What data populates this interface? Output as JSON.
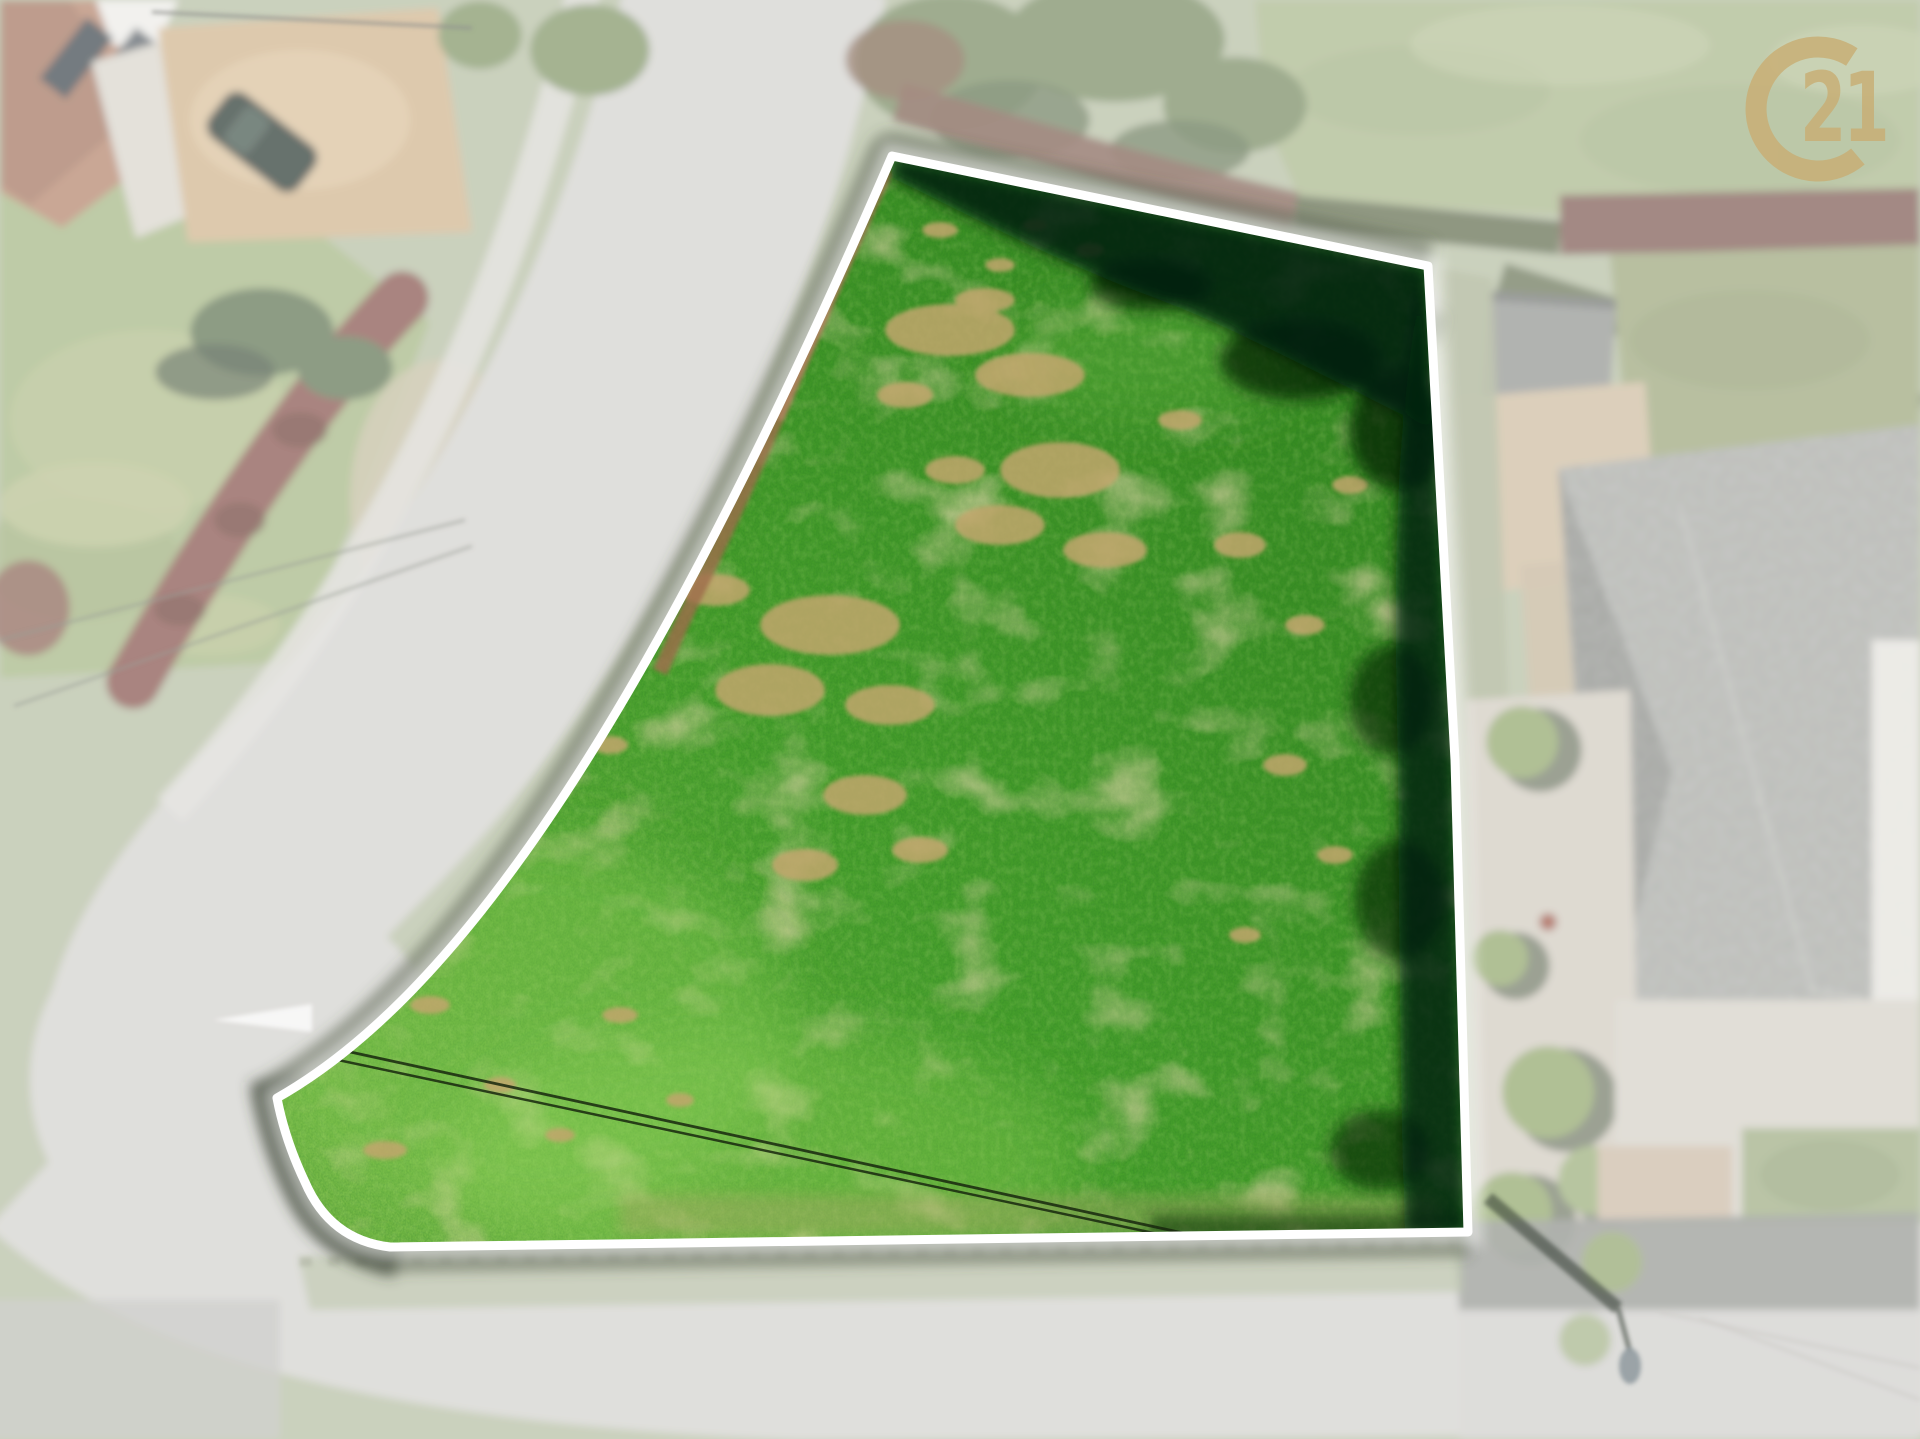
{
  "scene": {
    "description": "Aerial drone photo of a vacant corner building plot: vivid green meadow with dry tan patches, bounded by a white outline; surrounding roads, houses, hedges and lawns are blurred and whitened; curved road on the left, straight road along the bottom, neighbouring house with gray roof on the right, brand seal watermark top-right",
    "plot_outline": "white",
    "overlay_effect": "white translucent veil over blurred surroundings"
  },
  "logo": {
    "name": "century21-seal",
    "text": "21",
    "shape": "open C ring with digits in the gap",
    "color": "#c9ad72"
  },
  "colors": {
    "outline": "#ffffff",
    "gold": "#c9ad72",
    "grass-light": "#7ec04a",
    "grass-mid": "#4aa42c",
    "grass-dark": "#35881f",
    "dry-patch": "#c2a66d",
    "hedge-shadow": "#062009",
    "road": "#d2d1cd",
    "bg-base": "#b4bda1",
    "veil": "#ffffff"
  }
}
